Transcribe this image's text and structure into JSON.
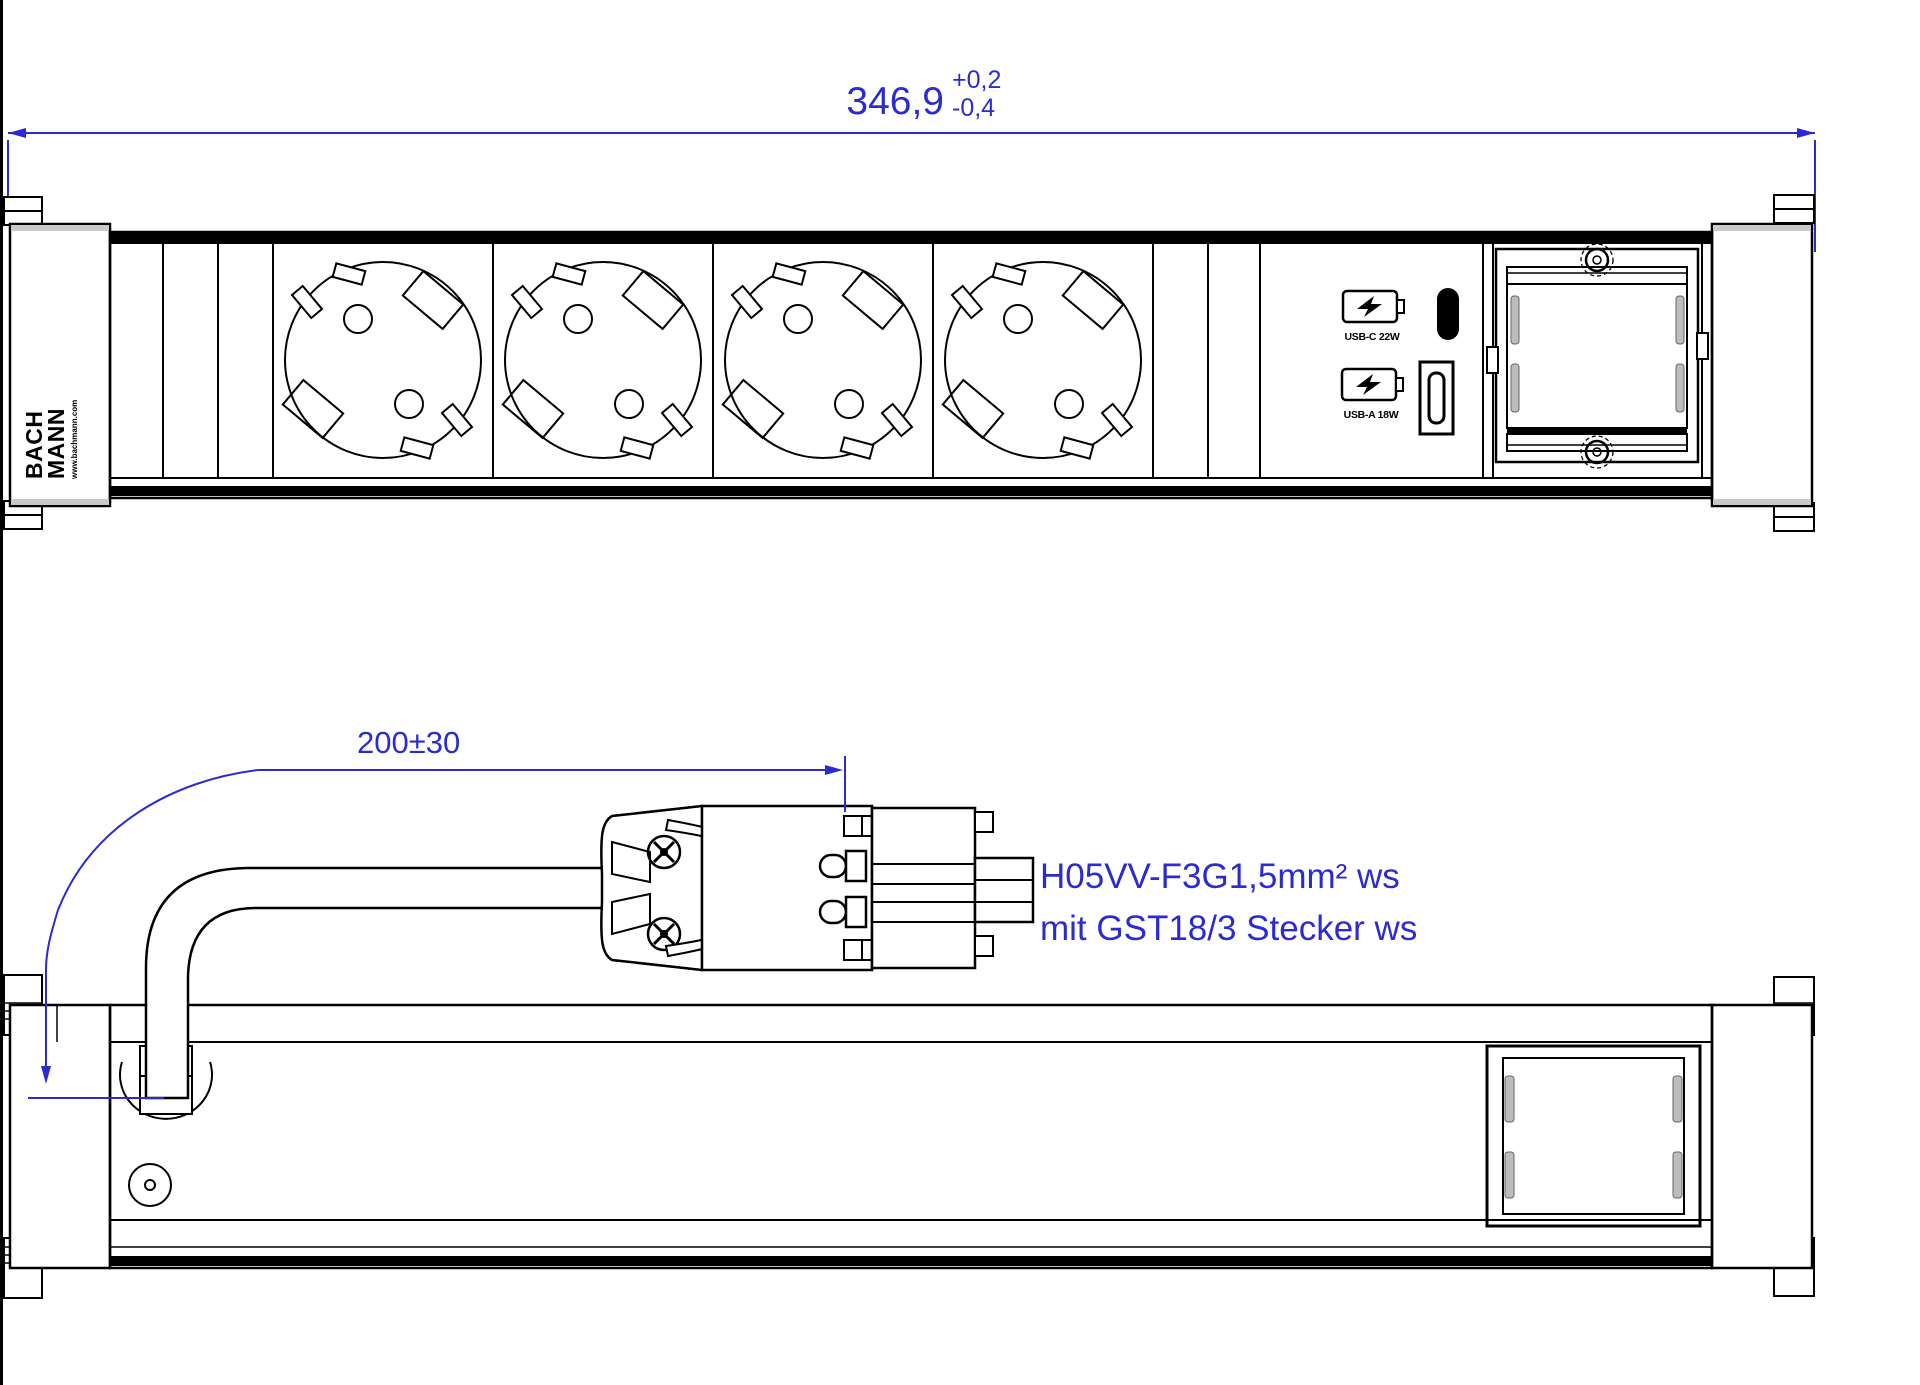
{
  "colors": {
    "background": "#ffffff",
    "drawing_lines": "#000000",
    "annotations": "#2b2bd0",
    "clip_shade": "#bdbdbd"
  },
  "dims": {
    "overall_width": {
      "value": "346,9",
      "tol_plus": "+0,2",
      "tol_minus": "-0,4"
    },
    "cable_length": {
      "value": "200±30"
    }
  },
  "cable_spec": {
    "line1": "H05VV-F3G1,5mm² ws",
    "line2": "mit GST18/3  Stecker ws"
  },
  "brand": {
    "line1": "BACH",
    "line2": "MANN",
    "website": "www.bachmann.com"
  },
  "usb_module": {
    "usb_c_label": "USB-C 22W",
    "usb_a_label": "USB-A 18W"
  },
  "structure": {
    "front_view": {
      "schuko_sockets": 4,
      "usb_ports": [
        "USB-C",
        "USB-A"
      ],
      "custom_module_slot": true
    },
    "bottom_view": {
      "cable": true,
      "plug_type": "GST18/3"
    }
  }
}
